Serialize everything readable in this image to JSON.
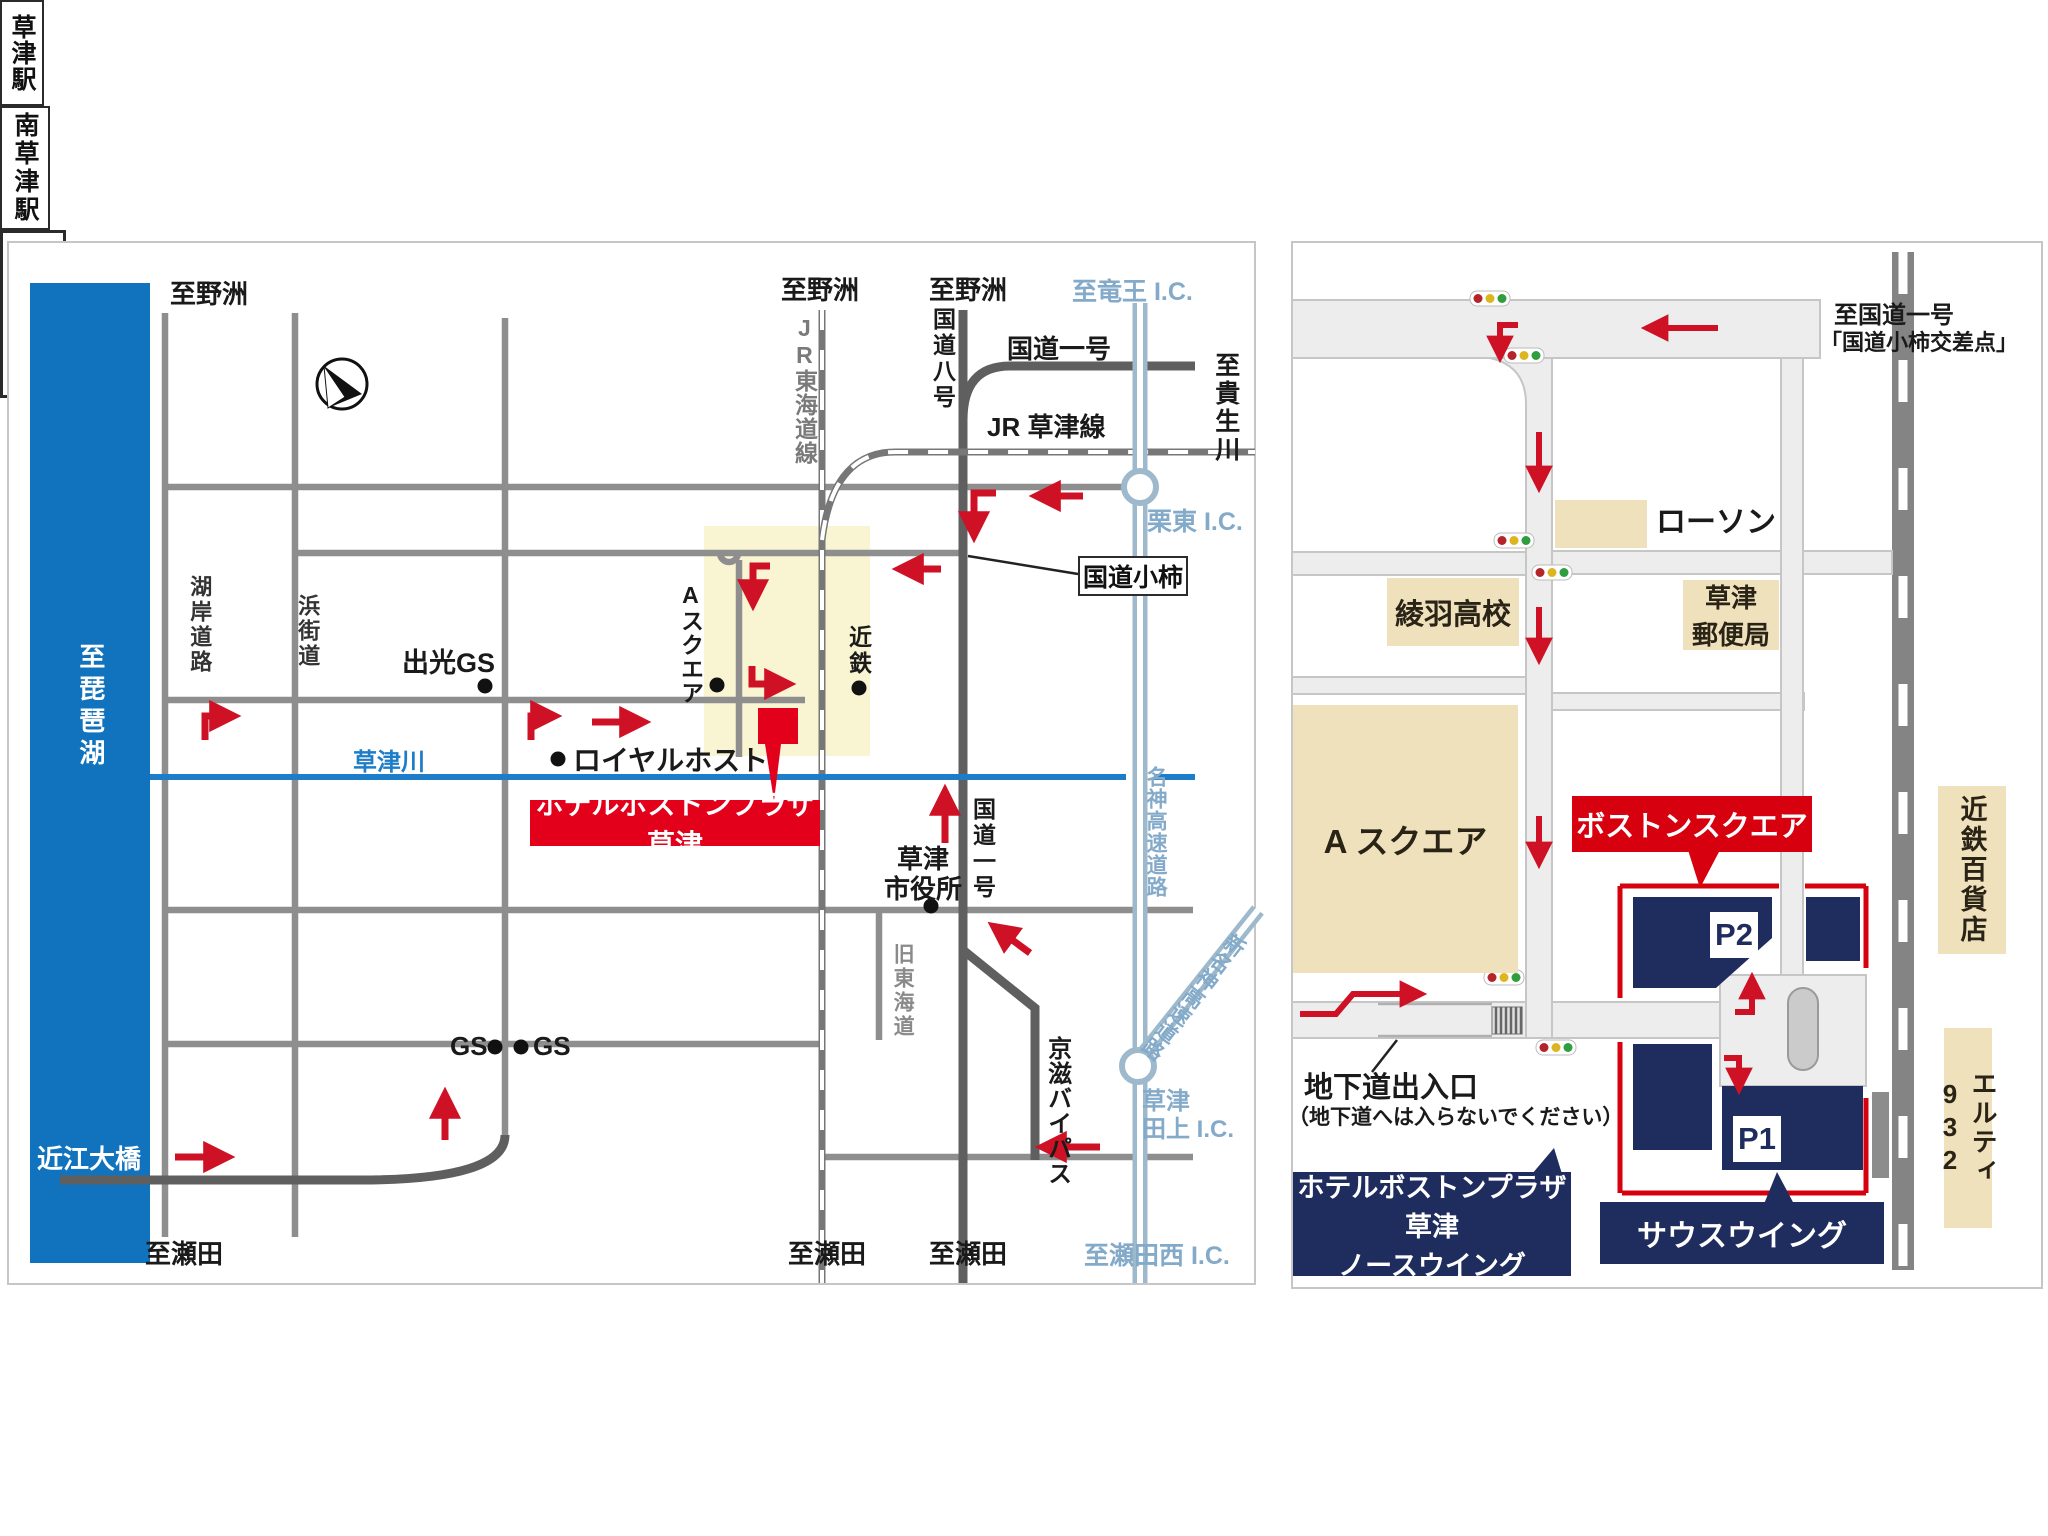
{
  "colors": {
    "lake_blue": "#1173bd",
    "river_blue": "#1e7dc8",
    "road_gray": "#8e8e8e",
    "major_road_gray": "#5f5f5f",
    "highway_steel": "#9fb9cc",
    "highway_text_blue": "#84aac9",
    "yellow_area": "#f9f5d2",
    "beige_box": "#f0e1bd",
    "navy": "#1f2c5e",
    "arrow_red": "#cf1126",
    "hotel_red": "#e3001b"
  },
  "left_map": {
    "to_yasu": "至野洲",
    "to_ryuo_ic": "至竜王 I.C.",
    "jr_tokaido_line": "JR東海道線",
    "route8": "国道八号",
    "route1_top": "国道一号",
    "jr_kusatsu_line": "JR 草津線",
    "to_kibugawa": "至貴生川",
    "ritto_ic": "栗東 I.C.",
    "kokudo_kogaki": "国道小柿",
    "kogan_road": "湖岸道路",
    "hama_kaido": "浜街道",
    "idemitsu_gs": "出光GS",
    "a_square": "Aスクエア",
    "kintetsu": "近鉄",
    "kusatsu_station": "草津駅",
    "royal_host": "ロイヤルホスト",
    "kusatsu_river": "草津川",
    "hotel_label": "ホテルボストンプラザ草津",
    "city_hall_l1": "草津",
    "city_hall_l2": "市役所",
    "route1_side": "国道一号",
    "old_tokaido": "旧東海道",
    "minami_kusatsu_station": "南草津駅",
    "gs": "GS",
    "meishin_expwy": "名神高速道路",
    "shin_meishin_expwy": "新名神高速道路",
    "keiji_bypass": "京滋バイパス",
    "kusatsu_tagami_ic_l1": "草津",
    "kusatsu_tagami_ic_l2": "田上 I.C.",
    "to_setanishi_ic": "至瀬田西 I.C.",
    "to_seta": "至瀬田",
    "to_biwako": "至琵琶湖",
    "omi_ohashi": "近江大橋"
  },
  "right_map": {
    "to_route1_l1": "至国道一号",
    "to_route1_l2": "「国道小柿交差点」",
    "lawson": "ローソン",
    "ayaha_high_school": "綾羽高校",
    "post_office_l1": "草津",
    "post_office_l2": "郵便局",
    "a_square": "A スクエア",
    "boston_square": "ボストンスクエア",
    "p2": "P2",
    "p1": "P1",
    "kusatsu_station": "草津駅",
    "kintetsu_dept": "近鉄百貨店",
    "elty932": "エルティ932",
    "underpass_l1": "地下道出入口",
    "underpass_l2": "（地下道へは入らないでください）",
    "hotel_north_l1": "ホテルボストンプラザ草津",
    "hotel_north_l2": "ノースウイング",
    "south_wing": "サウスウイング"
  }
}
